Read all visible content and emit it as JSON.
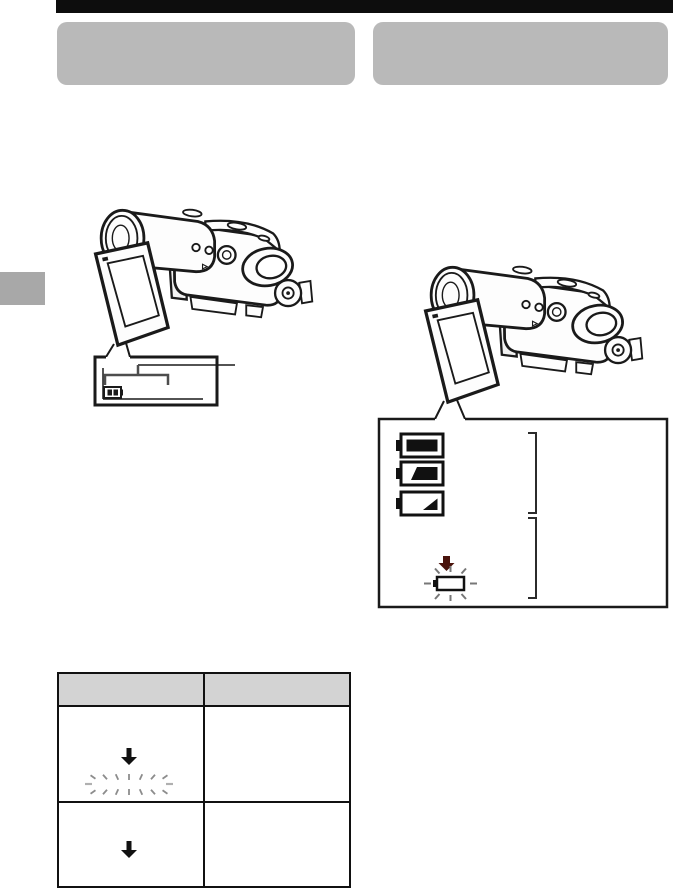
{
  "page": {
    "type": "camcorder-instruction-manual-page",
    "background": "#ffffff",
    "top_bar_color": "#0d0d0d",
    "heading_placeholder_color": "#b9b9b9",
    "side_tab_color": "#a8a8a8",
    "line_color": "#1a1a1a"
  },
  "headings": {
    "left_label": "",
    "right_label": ""
  },
  "figure_left": {
    "description": "camcorder-with-lcd-open",
    "callout": {
      "indicator_icon": "remaining-battery-time-indicator",
      "bracket_color": "#4d4d4d",
      "leader_line": "points-right-outside-box"
    }
  },
  "figure_right": {
    "description": "camcorder-with-lcd-open",
    "callout": {
      "battery_levels": [
        {
          "state": "full",
          "fill_fraction": 1.0
        },
        {
          "state": "partially-used",
          "fill_fraction": 0.55
        },
        {
          "state": "low",
          "fill_fraction": 0.2
        }
      ],
      "arrow_color": "#4a130c",
      "blinking_battery_state": "empty-flashing",
      "ray_color": "#777777",
      "bracket_color": "#2b2b2b"
    }
  },
  "table": {
    "header_fill": "#d3d3d3",
    "border_color": "#111111",
    "columns": [
      {
        "label": ""
      },
      {
        "label": ""
      }
    ],
    "rows": [
      {
        "indicator": "down-arrow-then-flashing-rays",
        "ray_color": "#8c8c8c",
        "side_ray_color": "#b0b0b0",
        "description": ""
      },
      {
        "indicator": "down-arrow",
        "description": ""
      }
    ]
  }
}
